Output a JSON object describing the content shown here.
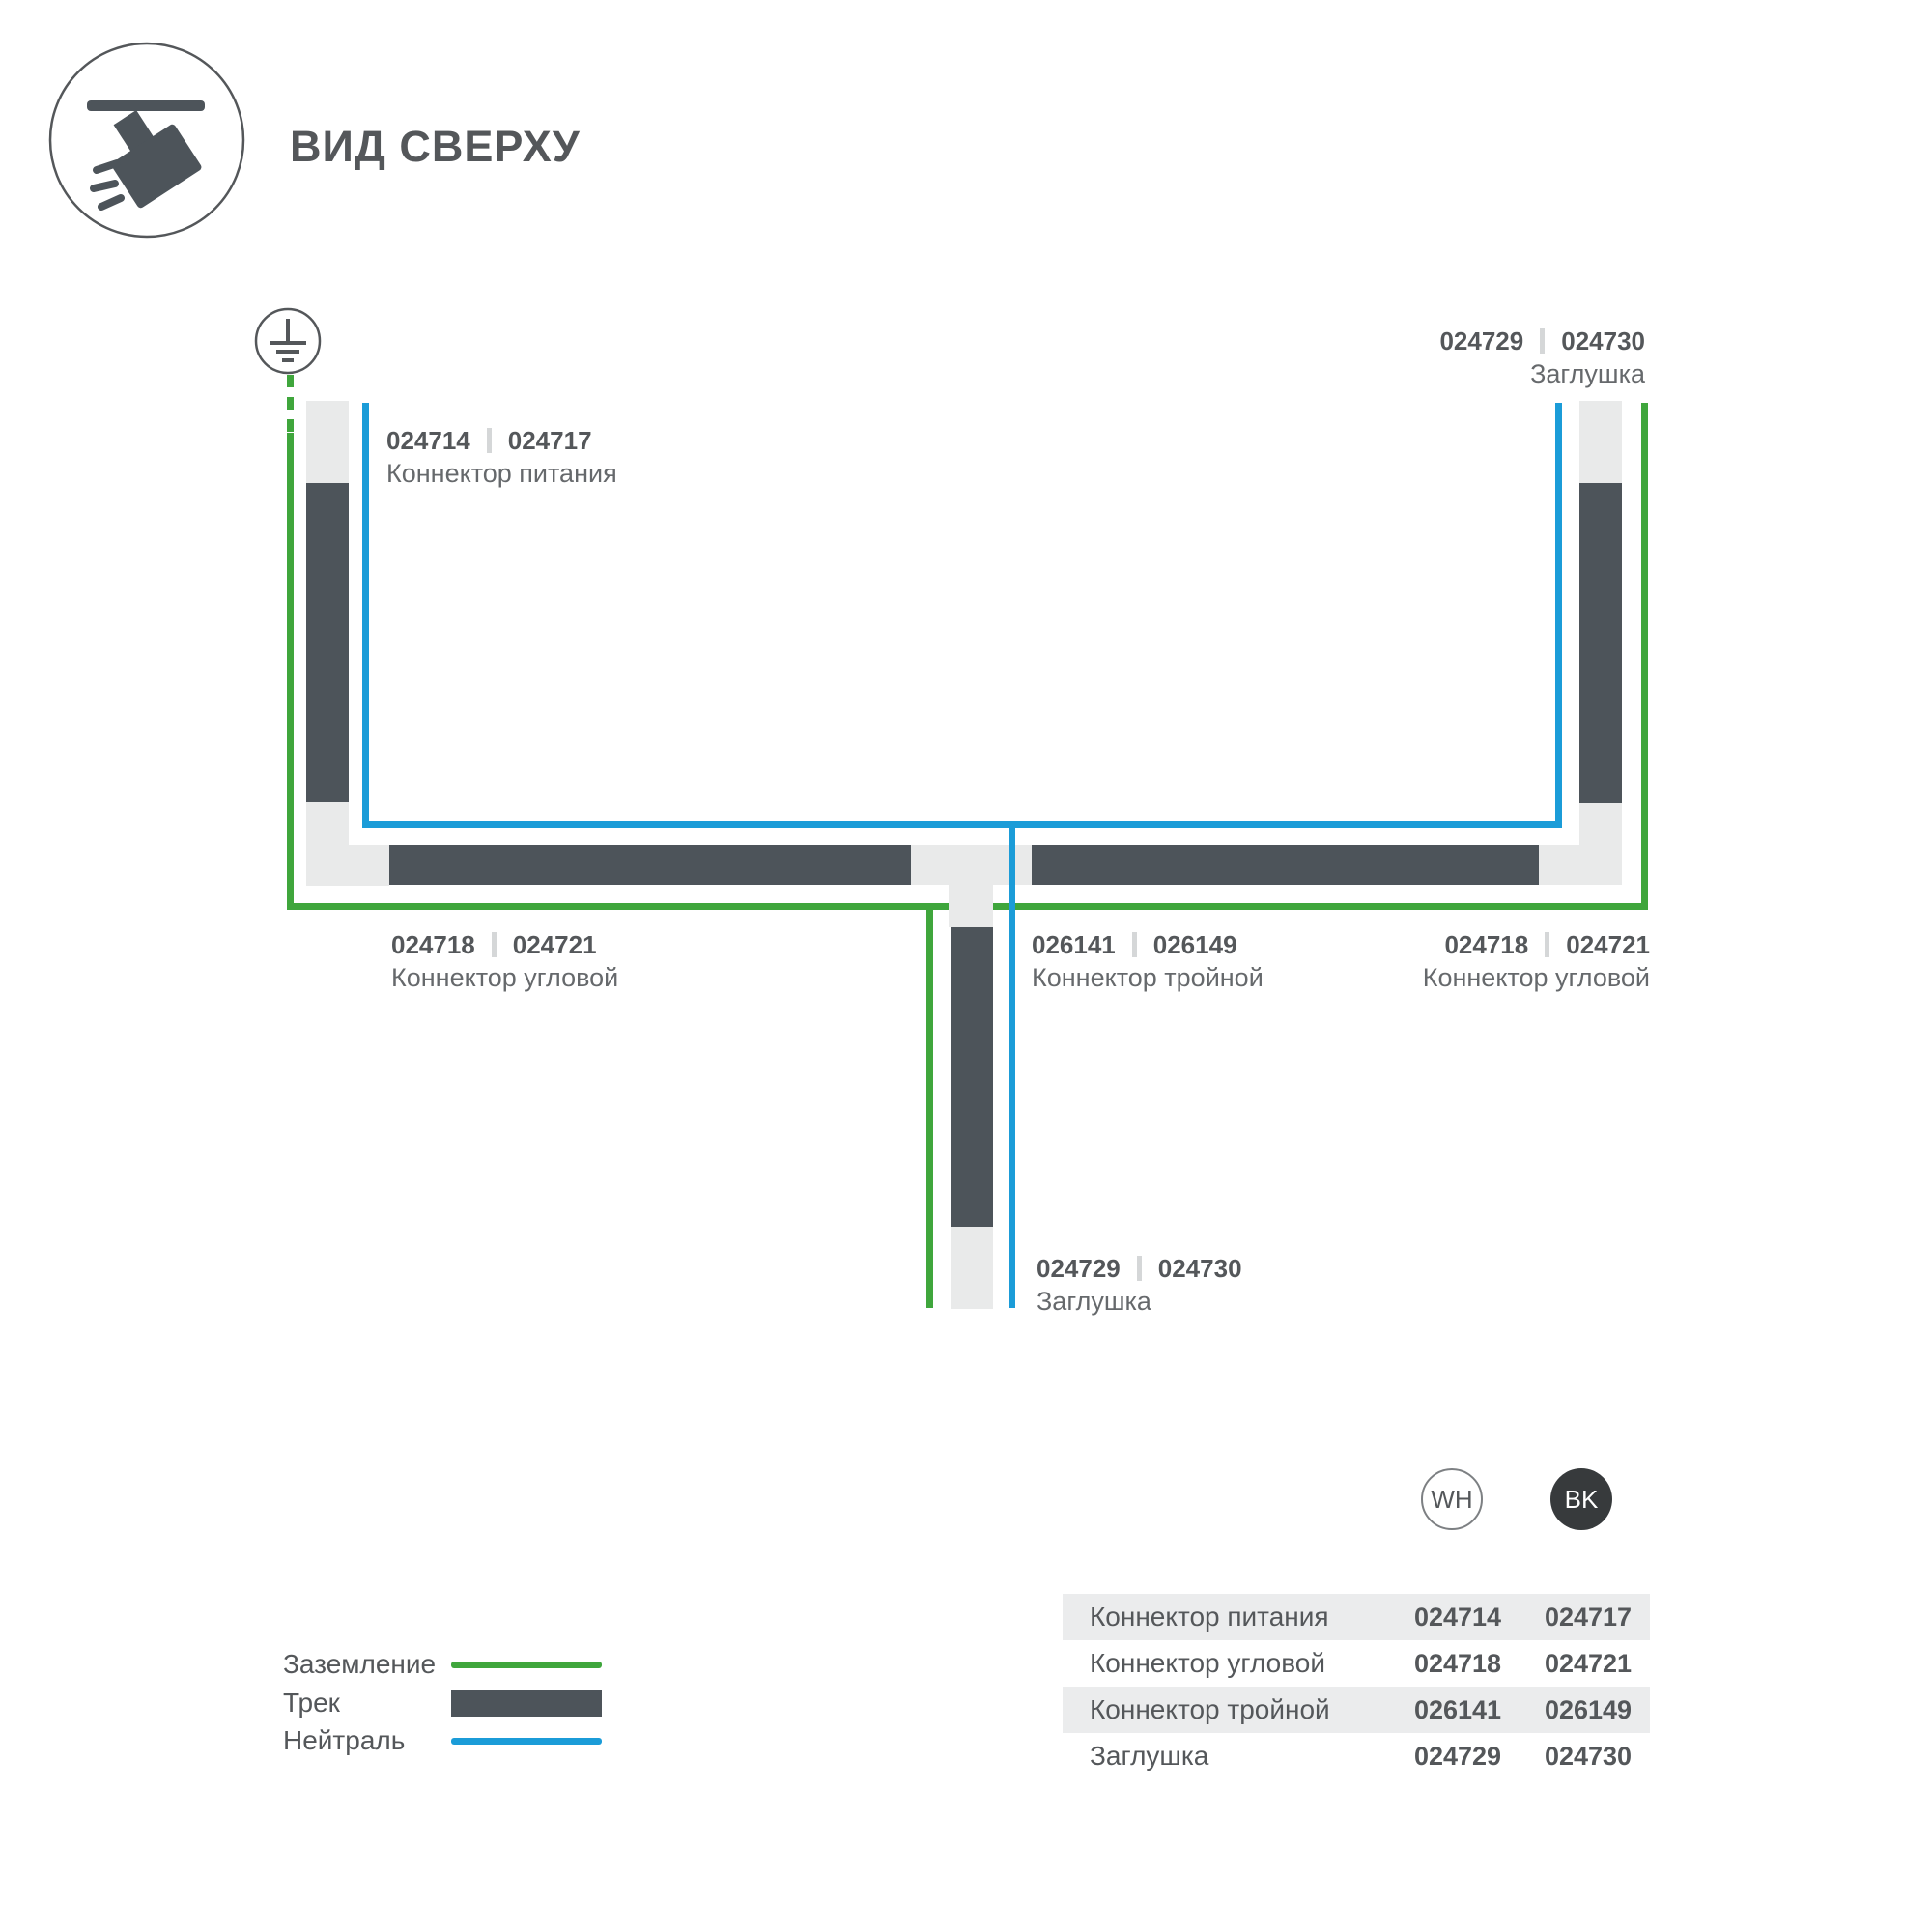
{
  "header": {
    "title": "ВИД СВЕРХУ",
    "icon": "track-spotlight-icon"
  },
  "diagram": {
    "labels": [
      {
        "code_wh": "024714",
        "code_bk": "024717",
        "name": "Коннектор питания"
      },
      {
        "code_wh": "024729",
        "code_bk": "024730",
        "name": "Заглушка"
      },
      {
        "code_wh": "024718",
        "code_bk": "024721",
        "name": "Коннектор угловой"
      },
      {
        "code_wh": "026141",
        "code_bk": "026149",
        "name": "Коннектор тройной"
      },
      {
        "code_wh": "024718",
        "code_bk": "024721",
        "name": "Коннектор угловой"
      },
      {
        "code_wh": "024729",
        "code_bk": "024730",
        "name": "Заглушка"
      }
    ],
    "colors": {
      "ground_wire": "#3fa63c",
      "neutral_wire": "#1b9cd8",
      "track_dark": "#4d545a",
      "track_light": "#e9eaea"
    }
  },
  "legend": {
    "items": [
      {
        "label": "Заземление",
        "type": "ground-line"
      },
      {
        "label": "Трек",
        "type": "track-bar"
      },
      {
        "label": "Нейтраль",
        "type": "neutral-line"
      }
    ]
  },
  "variants": {
    "white_label": "WH",
    "black_label": "BK"
  },
  "table": {
    "rows": [
      {
        "name": "Коннектор питания",
        "wh": "024714",
        "bk": "024717"
      },
      {
        "name": "Коннектор угловой",
        "wh": "024718",
        "bk": "024721"
      },
      {
        "name": "Коннектор тройной",
        "wh": "026141",
        "bk": "026149"
      },
      {
        "name": "Заглушка",
        "wh": "024729",
        "bk": "024730"
      }
    ]
  }
}
